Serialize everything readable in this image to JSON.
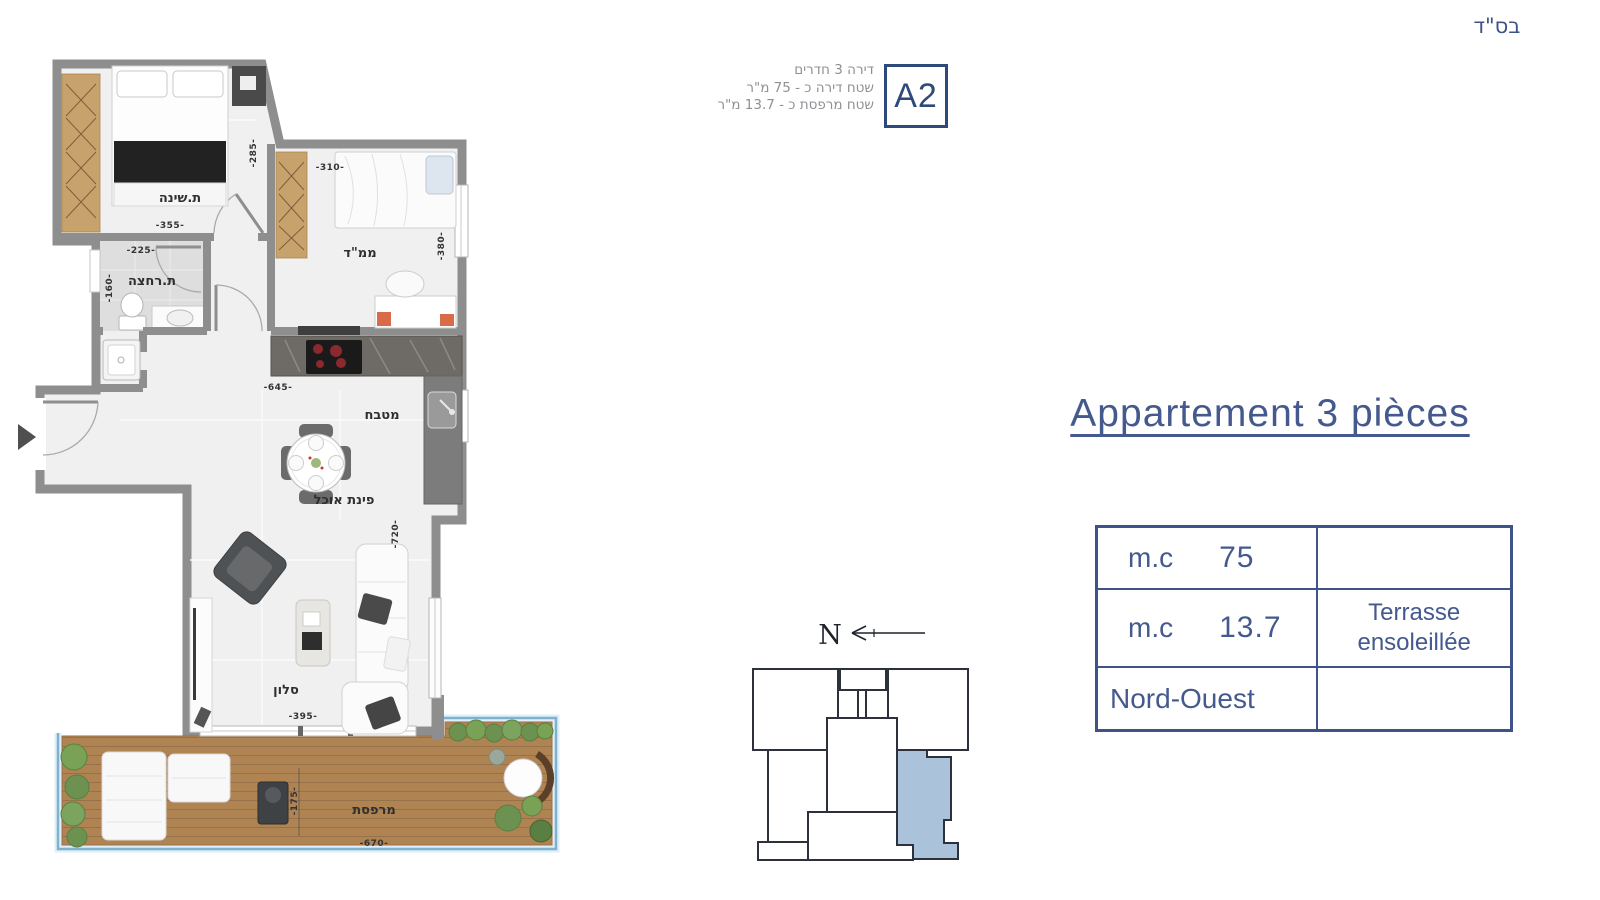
{
  "header": {
    "bsd": "בס\"ד",
    "info_lines": {
      "line1": "דירה 3 חדרים",
      "line2": "שטח דירה כ - 75 מ\"ר",
      "line3": "שטח מרפסת כ - 13.7 מ\"ר"
    },
    "unit_code": "A2"
  },
  "title": "Appartement 3 pièces",
  "spec_table": {
    "rows": [
      {
        "label": "m.c",
        "value": "75",
        "note": ""
      },
      {
        "label": "m.c",
        "value": "13.7",
        "note": "Terrasse ensoleillée"
      },
      {
        "label": "Nord-Ouest",
        "value": "",
        "note": ""
      }
    ]
  },
  "north_indicator": {
    "label": "N"
  },
  "floor_plan": {
    "rooms": {
      "bedroom": {
        "label": "ת.שינה"
      },
      "mamad": {
        "label": "ממ\"ד"
      },
      "bathroom": {
        "label": "ת.רחצה"
      },
      "kitchen": {
        "label": "מטבח"
      },
      "dining": {
        "label": "פינת אוכל"
      },
      "living": {
        "label": "סלון"
      },
      "balcony": {
        "label": "מרפסת"
      }
    },
    "dimensions_cm": {
      "bedroom_w": "-355-",
      "bedroom_h": "-285-",
      "bathroom_w": "-225-",
      "bathroom_h": "-160-",
      "mamad_w": "-310-",
      "mamad_h": "-380-",
      "kitchen_w": "-645-",
      "living_w": "-395-",
      "living_h": "-720-",
      "balcony_w": "-670-",
      "balcony_h": "-175-"
    }
  },
  "colors": {
    "accent_blue": "#3e5489",
    "unit_box_blue": "#2e4a7a",
    "wall_gray": "#8e8e8e",
    "highlight_unit": "#aac3da",
    "railing_blue": "#7fb2cc",
    "deck_wood": "#b08353",
    "wardrobe_wood": "#c8a26c",
    "plant_green": "#6c9150"
  }
}
